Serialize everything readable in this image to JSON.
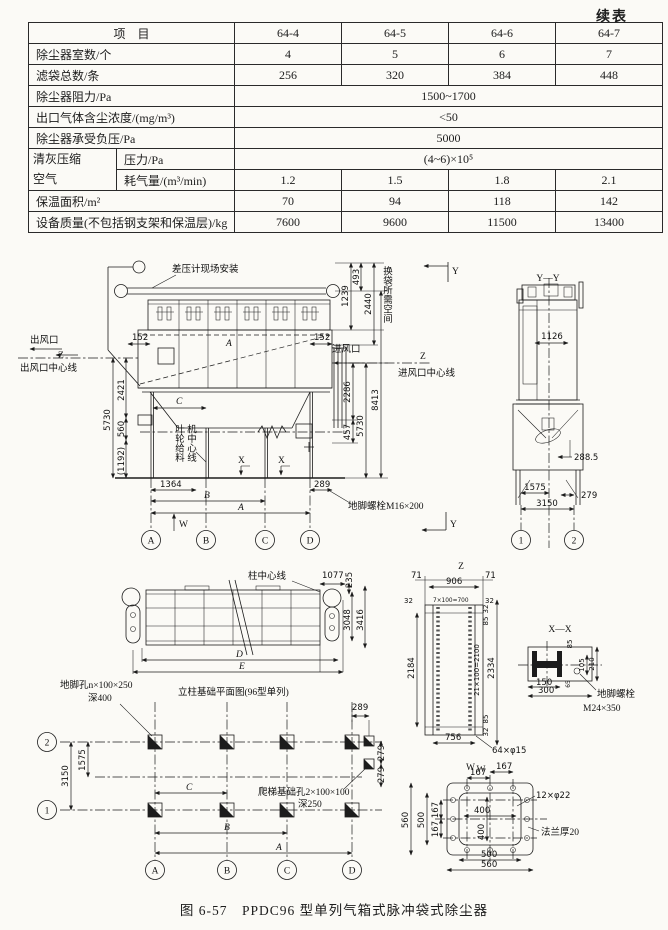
{
  "colors": {
    "paper": "#fbfaf6",
    "ink": "#1c1c1c"
  },
  "table": {
    "continued": "续表",
    "header": {
      "item": "项　目",
      "cols": [
        "64-4",
        "64-5",
        "64-6",
        "64-7"
      ]
    },
    "rows": [
      {
        "label": "除尘器室数/个",
        "v": [
          "4",
          "5",
          "6",
          "7"
        ]
      },
      {
        "label": "滤袋总数/条",
        "v": [
          "256",
          "320",
          "384",
          "448"
        ]
      },
      {
        "label": "除尘器阻力/Pa",
        "span": "1500~1700"
      },
      {
        "label": "出口气体含尘浓度/(mg/m³)",
        "span": "<50"
      },
      {
        "label": "除尘器承受负压/Pa",
        "span": "5000"
      },
      {
        "group1": "清灰压缩",
        "group2": "空气",
        "sub": "压力/Pa",
        "span": "(4~6)×10⁵"
      },
      {
        "sub": "耗气量/(m³/min)",
        "v": [
          "1.2",
          "1.5",
          "1.8",
          "2.1"
        ]
      },
      {
        "label": "保温面积/m²",
        "v": [
          "70",
          "94",
          "118",
          "142"
        ]
      },
      {
        "label": "设备质量(不包括钢支架和保温层)/kg",
        "v": [
          "7600",
          "9600",
          "11500",
          "13400"
        ]
      }
    ]
  },
  "dwg": {
    "front": {
      "gauge_label": "差压计现场安装",
      "outlet": "出风口",
      "z_left": "Z",
      "outlet_cl": "出风口中心线",
      "d152l": "152",
      "a_body": "A",
      "d152r": "152",
      "inlet": "进风口",
      "z_right": "Z",
      "inlet_cl": "进风口中心线",
      "d1239": "1239",
      "d493": "493",
      "d2440": "2440",
      "bag_space": "换袋所需空间",
      "d2286": "2286",
      "d457": "457",
      "d8413": "8413",
      "d5730r": "5730",
      "d5730l": "5730",
      "d2421": "2421",
      "d560": "560",
      "d1192": "(1192)",
      "c_dim": "C",
      "feeder1": "叶轮给料",
      "feeder2": "机中心线",
      "x1": "X",
      "x2": "X",
      "d1364": "1364",
      "b_dim": "B",
      "a_dim": "A",
      "d289": "289",
      "anchor": "地脚螺栓M16×200",
      "w_mark": "W",
      "cols": [
        "A",
        "B",
        "C",
        "D"
      ],
      "y_top": "Y",
      "y_bot": "Y"
    },
    "yy": {
      "title": "Y—Y",
      "d1126": "1126",
      "d2885": "288.5",
      "d1575": "1575",
      "d279": "279",
      "d3150": "3150",
      "cols": [
        "1",
        "2"
      ]
    },
    "plan": {
      "col_cl": "柱中心线",
      "d1077": "1077",
      "d235": "235",
      "d3048": "3048",
      "d3416": "3416",
      "d_dim": "D",
      "e_dim": "E"
    },
    "zv": {
      "title": "Z",
      "d71l": "71",
      "d906": "906",
      "d71r": "71",
      "d32a": "32",
      "d700": "7×100=700",
      "d32b": "32",
      "d2184": "2184",
      "d2100": "21×100=2100",
      "d32c": "32",
      "d85a": "85",
      "d85b": "85",
      "d32d": "32",
      "d2334": "2334",
      "d756": "756",
      "holes": "64×φ15",
      "w_mark": "W"
    },
    "xx": {
      "title": "X—X",
      "d85": "85",
      "d105": "105",
      "d210": "210",
      "d150": "150",
      "d300": "300",
      "d65": "65",
      "bolt1": "地脚螺栓",
      "bolt2": "M24×350"
    },
    "wv": {
      "title": "W",
      "d167a": "167",
      "d167b": "167",
      "holes": "12×φ22",
      "flange": "法兰厚20",
      "d400h": "400",
      "d400v": "400",
      "d500b": "500",
      "d560b": "560",
      "d167c": "167",
      "d167d": "167",
      "d500l": "500",
      "d560l": "560"
    },
    "found": {
      "hole1": "地脚孔n×100×250",
      "hole2": "深400",
      "title": "立柱基础平面图(96型单列)",
      "d1575": "1575",
      "d3150": "3150",
      "c_dim": "C",
      "b_dim": "B",
      "a_dim": "A",
      "d289": "289",
      "d279a": "279",
      "d279b": "279",
      "ladder1": "爬梯基础孔2×100×100",
      "ladder2": "深250",
      "rows": [
        "2",
        "1"
      ],
      "cols": [
        "A",
        "B",
        "C",
        "D"
      ]
    }
  },
  "caption": "图 6-57　PPDC96 型单列气箱式脉冲袋式除尘器"
}
